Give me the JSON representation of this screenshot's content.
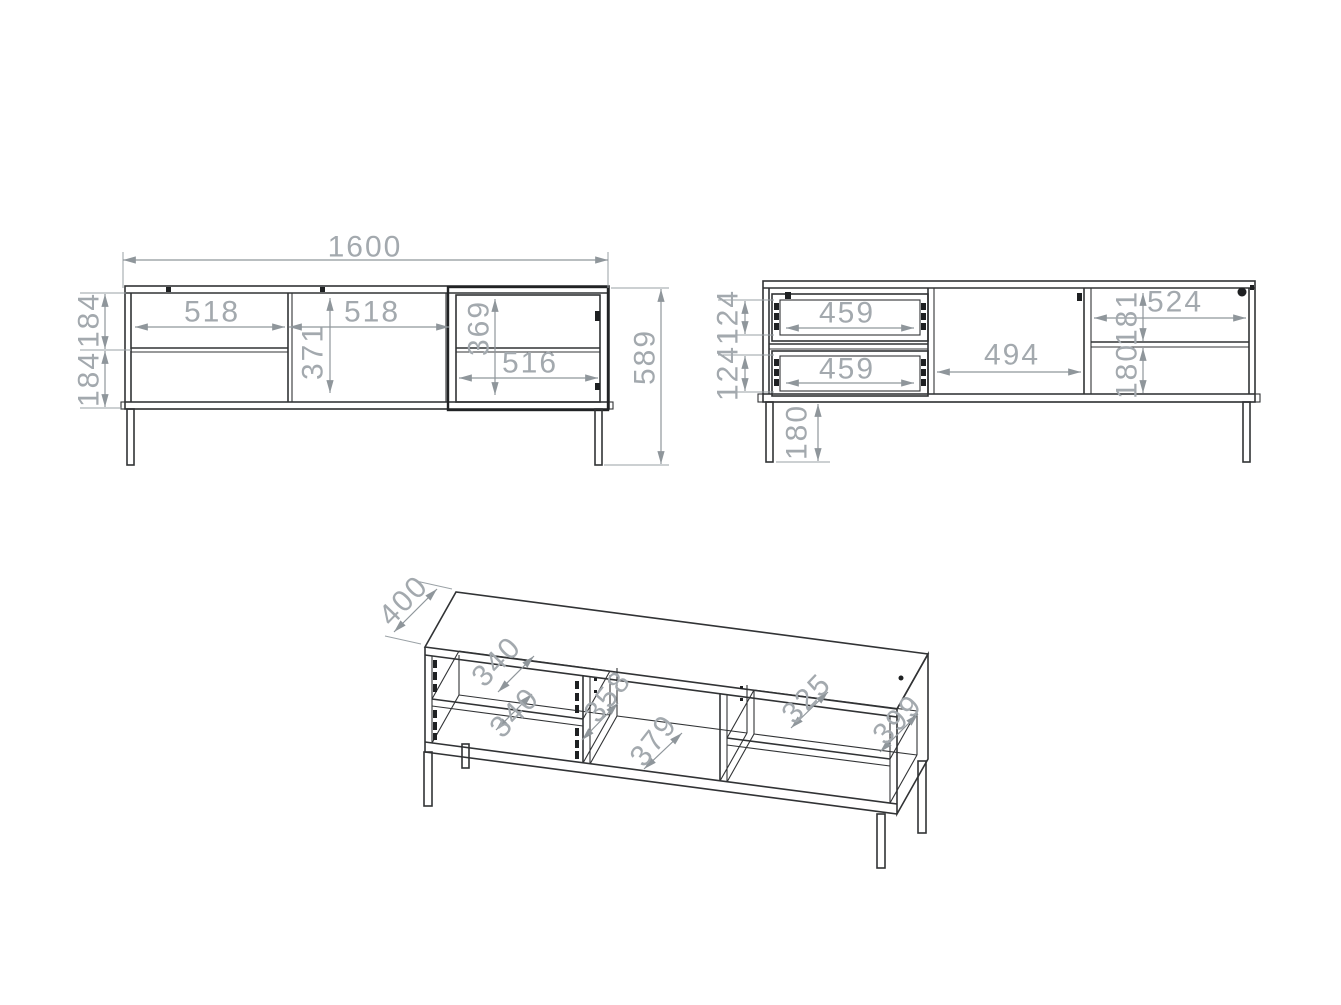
{
  "drawing": {
    "front": {
      "total_width": "1600",
      "left_width": "518",
      "middle_width": "518",
      "middle_height": "371",
      "glass_height": "369",
      "glass_width": "516",
      "overall_height": "589",
      "drawer_front_upper": "184",
      "drawer_front_lower": "184"
    },
    "back": {
      "drawer_upper_width": "459",
      "drawer_lower_width": "459",
      "middle_width": "494",
      "right_width": "524",
      "right_upper_height": "181",
      "right_lower_height": "180",
      "drawer_upper_side": "124",
      "drawer_lower_side": "124",
      "leg_height": "180"
    },
    "iso": {
      "top_depth": "400",
      "drawer_upper_depth": "340",
      "drawer_lower_depth": "340",
      "middle_depth": "358",
      "bottom_depth": "379",
      "shelf_depth": "325",
      "side_depth": "399"
    }
  }
}
